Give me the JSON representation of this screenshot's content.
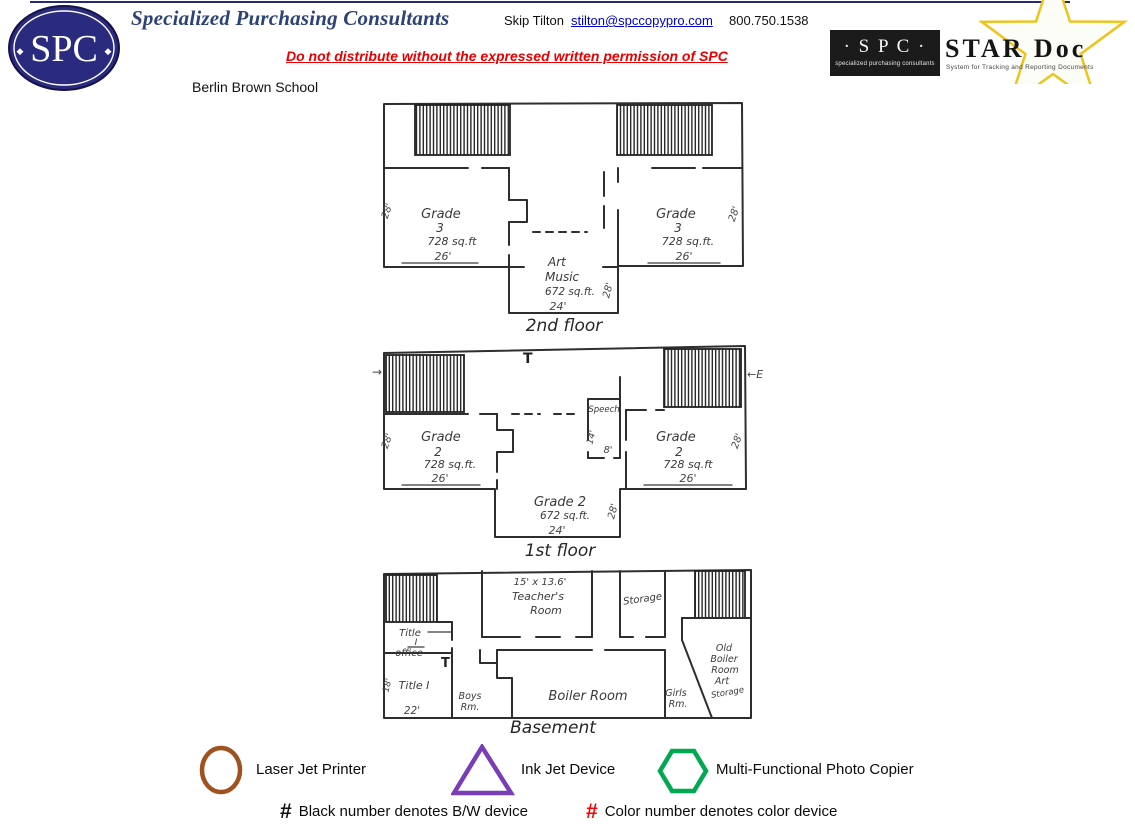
{
  "header": {
    "brand": "Specialized Purchasing Consultants",
    "logo": "SPC",
    "logo_deco": "◆",
    "contact": {
      "name": "Skip Tilton",
      "email": "stilton@spccopypro.com",
      "phone": "800.750.1538"
    },
    "warning": "Do not distribute without the expressed written permission of SPC",
    "school": "Berlin Brown School",
    "stardoc": {
      "spc": "· S P C ·",
      "sub": "specialized purchasing consultants",
      "title": "STAR Doc",
      "subtitle": "System for Tracking and Reporting Documents"
    }
  },
  "colors": {
    "brand_navy": "#2A2A7E",
    "title_navy": "#2D4377",
    "warning_red": "#E60000",
    "link_blue": "#0000CC",
    "star_yellow": "#EFC319",
    "plan_ink": "#3A3A3A"
  },
  "floor2": {
    "label": "2nd floor",
    "left": {
      "l1": "Grade",
      "l2": "3",
      "l3": "728 sq.ft",
      "w": "26'",
      "h": "28'"
    },
    "right": {
      "l1": "Grade",
      "l2": "3",
      "l3": "728 sq.ft.",
      "w": "26'",
      "h": "28'"
    },
    "center": {
      "l1": "Art",
      "l2": "Music",
      "l3": "672 sq.ft.",
      "w": "24'",
      "h": "28'"
    }
  },
  "floor1": {
    "label": "1st floor",
    "left": {
      "l1": "Grade",
      "l2": "2",
      "l3": "728 sq.ft.",
      "w": "26'",
      "h": "28'"
    },
    "right": {
      "l1": "Grade",
      "l2": "2",
      "l3": "728 sq.ft",
      "w": "26'",
      "h": "28'"
    },
    "center": {
      "l1": "Grade 2",
      "l2": "672 sq.ft.",
      "w": "24'",
      "h": "28'"
    },
    "speech": {
      "l1": "Speech",
      "w": "8'",
      "h": "14'"
    },
    "marks": {
      "left_arrow": "→",
      "right_entry": "←E",
      "t": "T"
    }
  },
  "basement": {
    "label": "Basement",
    "teachers": {
      "l1": "15' x 13.6'",
      "l2": "Teacher's",
      "l3": "Room"
    },
    "storage": "Storage",
    "title_office": {
      "l1": "Title",
      "l2": "I",
      "l3": "office"
    },
    "title1": {
      "l1": "Title I",
      "w": "22'",
      "h": "18'"
    },
    "boys": {
      "l1": "Boys",
      "l2": "Rm."
    },
    "girls": {
      "l1": "Girls",
      "l2": "Rm."
    },
    "boiler": "Boiler Room",
    "old_boiler": {
      "l1": "Old",
      "l2": "Boiler",
      "l3": "Room",
      "l4": "Art",
      "l5": "Storage"
    },
    "t": "T"
  },
  "legend": {
    "devices": [
      {
        "shape": "circle",
        "color": "#A0521E",
        "label": "Laser Jet Printer"
      },
      {
        "shape": "triangle",
        "color": "#7A3DB8",
        "label": "Ink Jet Device"
      },
      {
        "shape": "hexagon",
        "color": "#00A950",
        "label": "Multi-Functional Photo Copier"
      }
    ],
    "notes": [
      {
        "symbol": "#",
        "color": "#111111",
        "label": "Black number denotes B/W device"
      },
      {
        "symbol": "#",
        "color": "#FF0000",
        "label": "Color number denotes color device"
      }
    ]
  }
}
